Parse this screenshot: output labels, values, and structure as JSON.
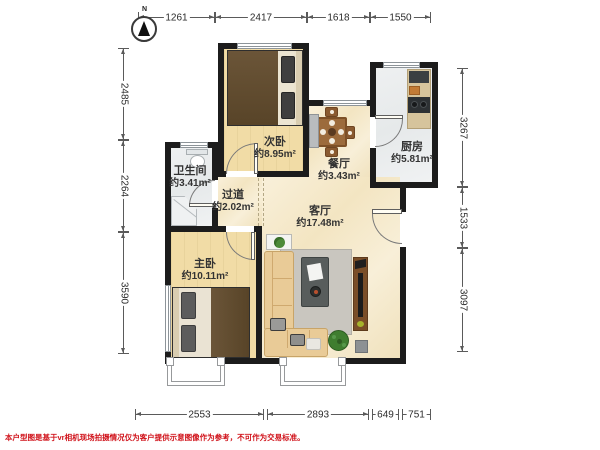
{
  "compass": {
    "label": "N"
  },
  "dims": {
    "top": [
      "1261",
      "2417",
      "1618",
      "1550"
    ],
    "left": [
      "2485",
      "2264",
      "3590"
    ],
    "right": [
      "3267",
      "1533",
      "3097"
    ],
    "bottom": [
      "2553",
      "2893",
      "649",
      "751"
    ]
  },
  "rooms": {
    "secondary_bedroom": {
      "name": "次卧",
      "area": "约8.95m²"
    },
    "dining": {
      "name": "餐厅",
      "area": "约3.43m²"
    },
    "kitchen": {
      "name": "厨房",
      "area": "约5.81m²"
    },
    "bathroom": {
      "name": "卫生间",
      "area": "约3.41m²"
    },
    "hallway": {
      "name": "过道",
      "area": "约2.02m²"
    },
    "living": {
      "name": "客厅",
      "area": "约17.48m²"
    },
    "master_bedroom": {
      "name": "主卧",
      "area": "约10.11m²"
    }
  },
  "disclaimer": "本户型图是基于vr相机现场拍摄情况仅为客户提供示意图像作为参考，不可作为交易标准。",
  "colors": {
    "wall": "#1c1c1c",
    "wood_floor": "#f1dca6",
    "tile_floor": "#ebedee",
    "main_floor": "#f7eed8",
    "disclaimer_red": "#d0121a"
  }
}
